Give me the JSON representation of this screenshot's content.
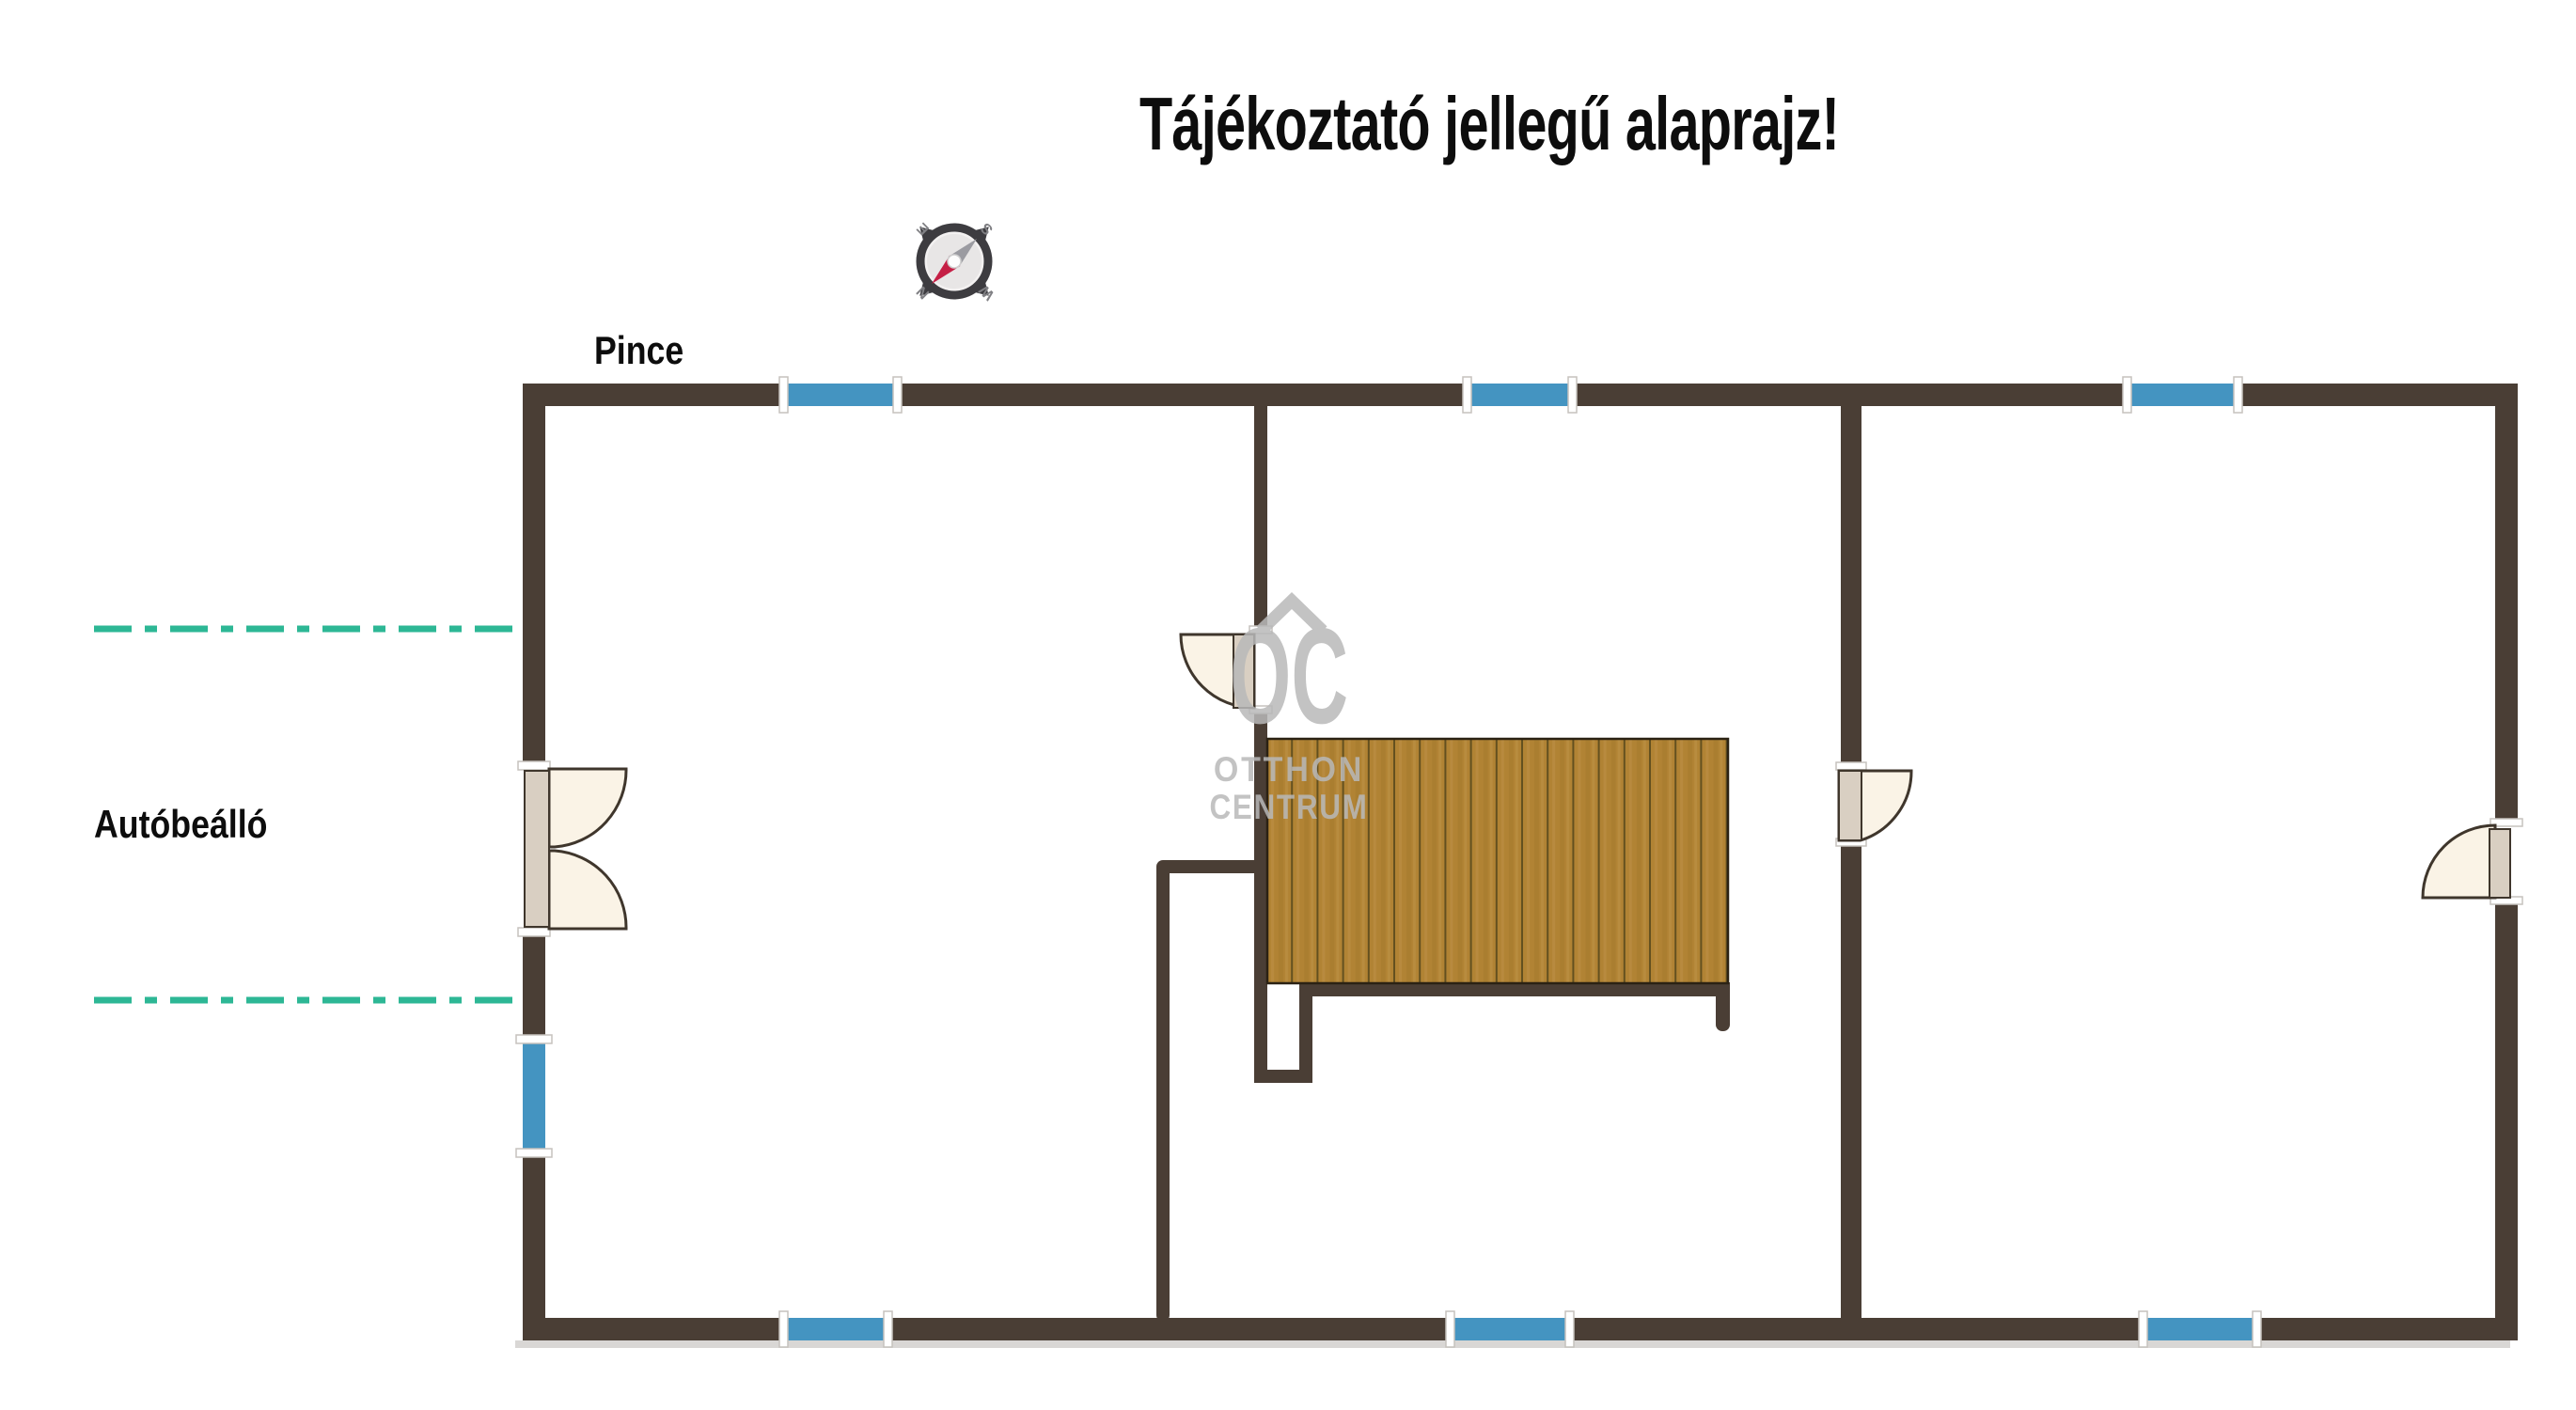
{
  "title": "Tájékoztató jellegű alaprajz!",
  "labels": {
    "floor": "Pince",
    "outside_area": "Autóbeálló"
  },
  "watermark": {
    "logo": "OC",
    "line1": "OTTHON",
    "line2": "CENTRUM"
  },
  "compass": {
    "north": "N",
    "east": "E",
    "south": "S",
    "west": "W",
    "rotation_deg": 225
  },
  "colors": {
    "wall_brown": "#4a3e35",
    "window_blue": "#4494c1",
    "window_frame_white": "#ffffff",
    "frame_border_gray": "#c6c2bd",
    "door_swing_cream": "#faf3e6",
    "door_leaf_beige": "#d9cfc2",
    "door_outline": "#3f362c",
    "stairs_wood": "#b18334",
    "stairs_plank_line": "#63501f",
    "boundary_teal": "#2db795",
    "watermark_gray": "#b9b9b9",
    "compass_needle_red": "#c51f45",
    "compass_needle_gray": "#9b9ba1",
    "compass_dark": "#3d3c40",
    "text_black": "#0d0d0d"
  },
  "plan_elements": {
    "windows": [
      "top-left",
      "top-middle",
      "top-right",
      "bottom-left",
      "bottom-middle",
      "bottom-right",
      "left-lower"
    ],
    "doors": [
      "left-double-entry",
      "interior-left-room",
      "interior-right-room",
      "right-side-entry"
    ],
    "stairs_planks": 18,
    "dashed_boundary_lines": 2
  }
}
